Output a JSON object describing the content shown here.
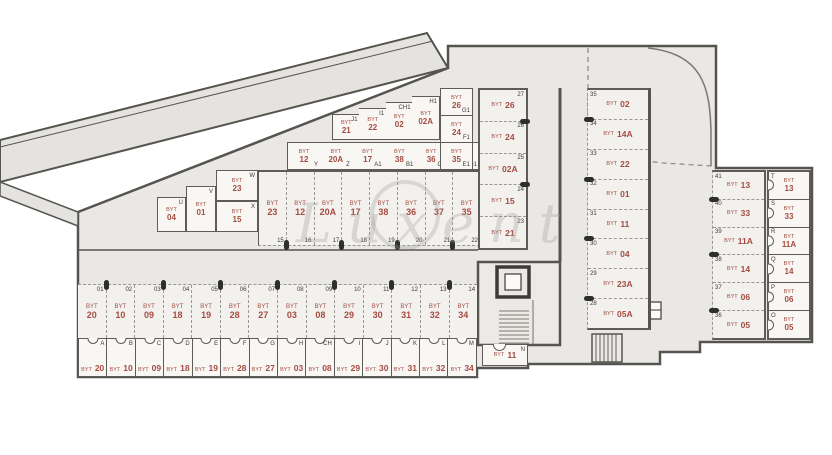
{
  "plan": {
    "watermark": "Luxent",
    "unit_prefix": "BYT",
    "bottom_parking": [
      {
        "num": "01",
        "unit": "20"
      },
      {
        "num": "02",
        "unit": "10"
      },
      {
        "num": "03",
        "unit": "09"
      },
      {
        "num": "04",
        "unit": "18"
      },
      {
        "num": "05",
        "unit": "19"
      },
      {
        "num": "06",
        "unit": "28"
      },
      {
        "num": "07",
        "unit": "27"
      },
      {
        "num": "08",
        "unit": "03"
      },
      {
        "num": "09",
        "unit": "08"
      },
      {
        "num": "10",
        "unit": "29"
      },
      {
        "num": "11",
        "unit": "30"
      },
      {
        "num": "12",
        "unit": "31"
      },
      {
        "num": "13",
        "unit": "32"
      },
      {
        "num": "14",
        "unit": "34"
      }
    ],
    "bottom_cellars": [
      {
        "letter": "A",
        "unit": "20"
      },
      {
        "letter": "B",
        "unit": "10"
      },
      {
        "letter": "C",
        "unit": "09"
      },
      {
        "letter": "D",
        "unit": "18"
      },
      {
        "letter": "E",
        "unit": "19"
      },
      {
        "letter": "F",
        "unit": "28"
      },
      {
        "letter": "G",
        "unit": "27"
      },
      {
        "letter": "H",
        "unit": "03"
      },
      {
        "letter": "CH",
        "unit": "08"
      },
      {
        "letter": "I",
        "unit": "29"
      },
      {
        "letter": "J",
        "unit": "30"
      },
      {
        "letter": "K",
        "unit": "31"
      },
      {
        "letter": "L",
        "unit": "32"
      },
      {
        "letter": "M",
        "unit": "34"
      }
    ],
    "room_n": {
      "letter": "N",
      "unit": "11"
    },
    "middle_parking": [
      {
        "num": "15",
        "unit": "23"
      },
      {
        "num": "16",
        "unit": "12"
      },
      {
        "num": "17",
        "unit": "20A"
      },
      {
        "num": "18",
        "unit": "17"
      },
      {
        "num": "19",
        "unit": "38"
      },
      {
        "num": "20",
        "unit": "36"
      },
      {
        "num": "21",
        "unit": "37"
      },
      {
        "num": "22",
        "unit": "35"
      }
    ],
    "left_diag_cellars": [
      {
        "letter": "U",
        "unit": "04"
      },
      {
        "letter": "V",
        "unit": "01"
      },
      {
        "letter": "W",
        "unit": "23"
      },
      {
        "letter": "X",
        "unit": "15"
      }
    ],
    "diag_cellars_lower": [
      {
        "letter": "Y",
        "unit": "12"
      },
      {
        "letter": "Z",
        "unit": "20A"
      },
      {
        "letter": "A1",
        "unit": "17"
      },
      {
        "letter": "B1",
        "unit": "38"
      },
      {
        "letter": "C1",
        "unit": "36"
      },
      {
        "letter": "D1",
        "unit": "37"
      }
    ],
    "diag_cellars_upper": [
      {
        "letter": "J1",
        "unit": "21"
      },
      {
        "letter": "I1",
        "unit": "22"
      },
      {
        "letter": "CH1",
        "unit": "02"
      },
      {
        "letter": "H1",
        "unit": "02A"
      }
    ],
    "stack_cellars": [
      {
        "letter": "G1",
        "unit": "26"
      },
      {
        "letter": "F1",
        "unit": "24"
      },
      {
        "letter": "E1",
        "unit": "35"
      }
    ],
    "central_parking": [
      {
        "num": "27",
        "unit": "26"
      },
      {
        "num": "26",
        "unit": "24"
      },
      {
        "num": "25",
        "unit": "02A"
      },
      {
        "num": "24",
        "unit": "15"
      },
      {
        "num": "23",
        "unit": "21"
      }
    ],
    "right_parking": [
      {
        "num": "35",
        "unit": "02"
      },
      {
        "num": "34",
        "unit": "14A"
      },
      {
        "num": "33",
        "unit": "22"
      },
      {
        "num": "32",
        "unit": "01"
      },
      {
        "num": "31",
        "unit": "11"
      },
      {
        "num": "30",
        "unit": "04"
      },
      {
        "num": "29",
        "unit": "23A"
      },
      {
        "num": "28",
        "unit": "05A"
      }
    ],
    "wing_parking": [
      {
        "num": "41",
        "unit": "13"
      },
      {
        "num": "40",
        "unit": "33"
      },
      {
        "num": "39",
        "unit": "11A"
      },
      {
        "num": "38",
        "unit": "14"
      },
      {
        "num": "37",
        "unit": "06"
      },
      {
        "num": "36",
        "unit": "05"
      }
    ],
    "wing_cellars": [
      {
        "letter": "T",
        "unit": "13"
      },
      {
        "letter": "S",
        "unit": "33"
      },
      {
        "letter": "R",
        "unit": "11A"
      },
      {
        "letter": "Q",
        "unit": "14"
      },
      {
        "letter": "P",
        "unit": "06"
      },
      {
        "letter": "O",
        "unit": "05"
      }
    ]
  }
}
